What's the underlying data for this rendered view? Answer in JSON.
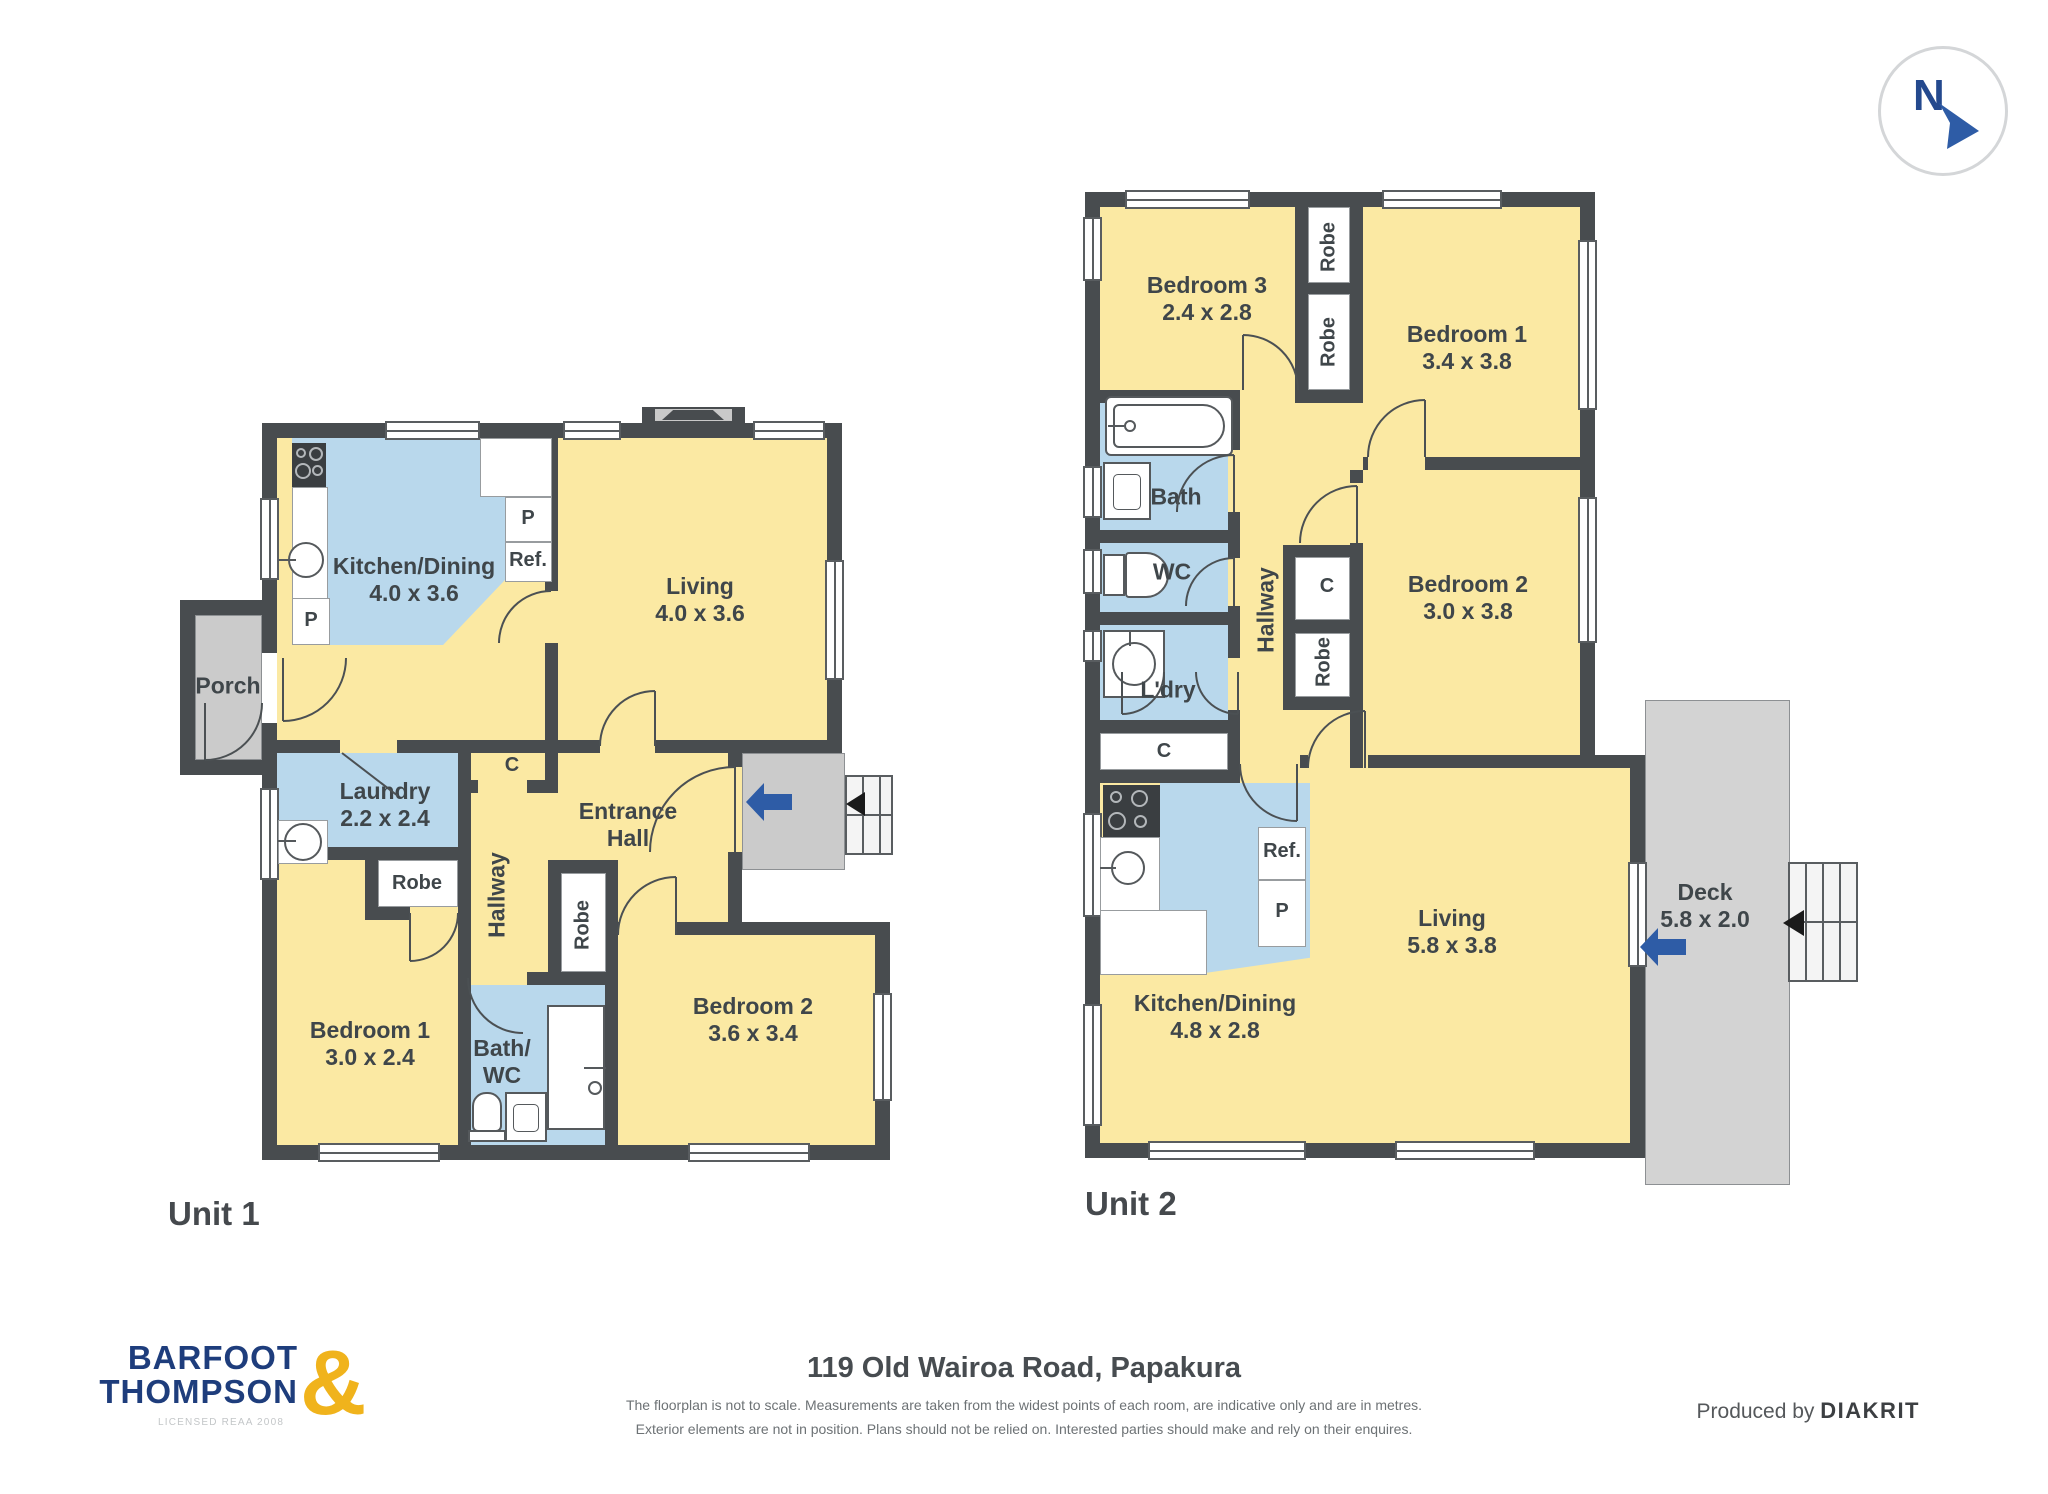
{
  "compass": {
    "label": "N"
  },
  "unit1": {
    "title": "Unit 1",
    "rooms": {
      "kitchen": {
        "lines": [
          "Kitchen/Dining",
          "4.0 x 3.6"
        ]
      },
      "living": {
        "lines": [
          "Living",
          "4.0 x 3.6"
        ]
      },
      "porch": {
        "lines": [
          "Porch"
        ]
      },
      "laundry": {
        "lines": [
          "Laundry",
          "2.2 x 2.4"
        ]
      },
      "entrance": {
        "lines": [
          "Entrance",
          "Hall"
        ]
      },
      "hallway": {
        "lines": [
          "Hallway"
        ]
      },
      "bedroom1": {
        "lines": [
          "Bedroom 1",
          "3.0 x 2.4"
        ]
      },
      "bathwc": {
        "lines": [
          "Bath/",
          "WC"
        ]
      },
      "bedroom2": {
        "lines": [
          "Bedroom 2",
          "3.6 x 3.4"
        ]
      }
    }
  },
  "unit2": {
    "title": "Unit 2",
    "rooms": {
      "bedroom3": {
        "lines": [
          "Bedroom 3",
          "2.4 x 2.8"
        ]
      },
      "bedroom1": {
        "lines": [
          "Bedroom 1",
          "3.4 x 3.8"
        ]
      },
      "bedroom2": {
        "lines": [
          "Bedroom 2",
          "3.0 x 3.8"
        ]
      },
      "bath": {
        "lines": [
          "Bath"
        ]
      },
      "wc": {
        "lines": [
          "WC"
        ]
      },
      "ldry": {
        "lines": [
          "L'dry"
        ]
      },
      "hallway": {
        "lines": [
          "Hallway"
        ]
      },
      "kitchen": {
        "lines": [
          "Kitchen/Dining",
          "4.8 x 2.8"
        ]
      },
      "living": {
        "lines": [
          "Living",
          "5.8 x 3.8"
        ]
      },
      "deck": {
        "lines": [
          "Deck",
          "5.8 x 2.0"
        ]
      }
    }
  },
  "labels": {
    "robe": "Robe",
    "closet": "C",
    "pantry": "P",
    "fridge": "Ref."
  },
  "footer": {
    "address": "119 Old Wairoa Road, Papakura",
    "disclaimer1": "The floorplan is not to scale. Measurements are taken from the widest points of each room, are indicative only and are in metres.",
    "disclaimer2": "Exterior elements are not in position. Plans should not be relied on. Interested parties should make and rely on their enquires.",
    "produced_by": "Produced by",
    "producer": "DIAKRIT",
    "logo": {
      "line1": "BARFOOT",
      "line2": "THOMPSON",
      "amp": "&",
      "sub": "LICENSED REAA 2008"
    }
  },
  "colors": {
    "wall": "#484c4f",
    "room_yellow": "#fbe9a3",
    "wet_area_blue": "#b9d8ec",
    "outdoor_gray": "#cbcbcb",
    "entry_arrow_blue": "#2e5ca6",
    "logo_navy": "#1e3d7c",
    "logo_gold": "#f0b31c"
  }
}
